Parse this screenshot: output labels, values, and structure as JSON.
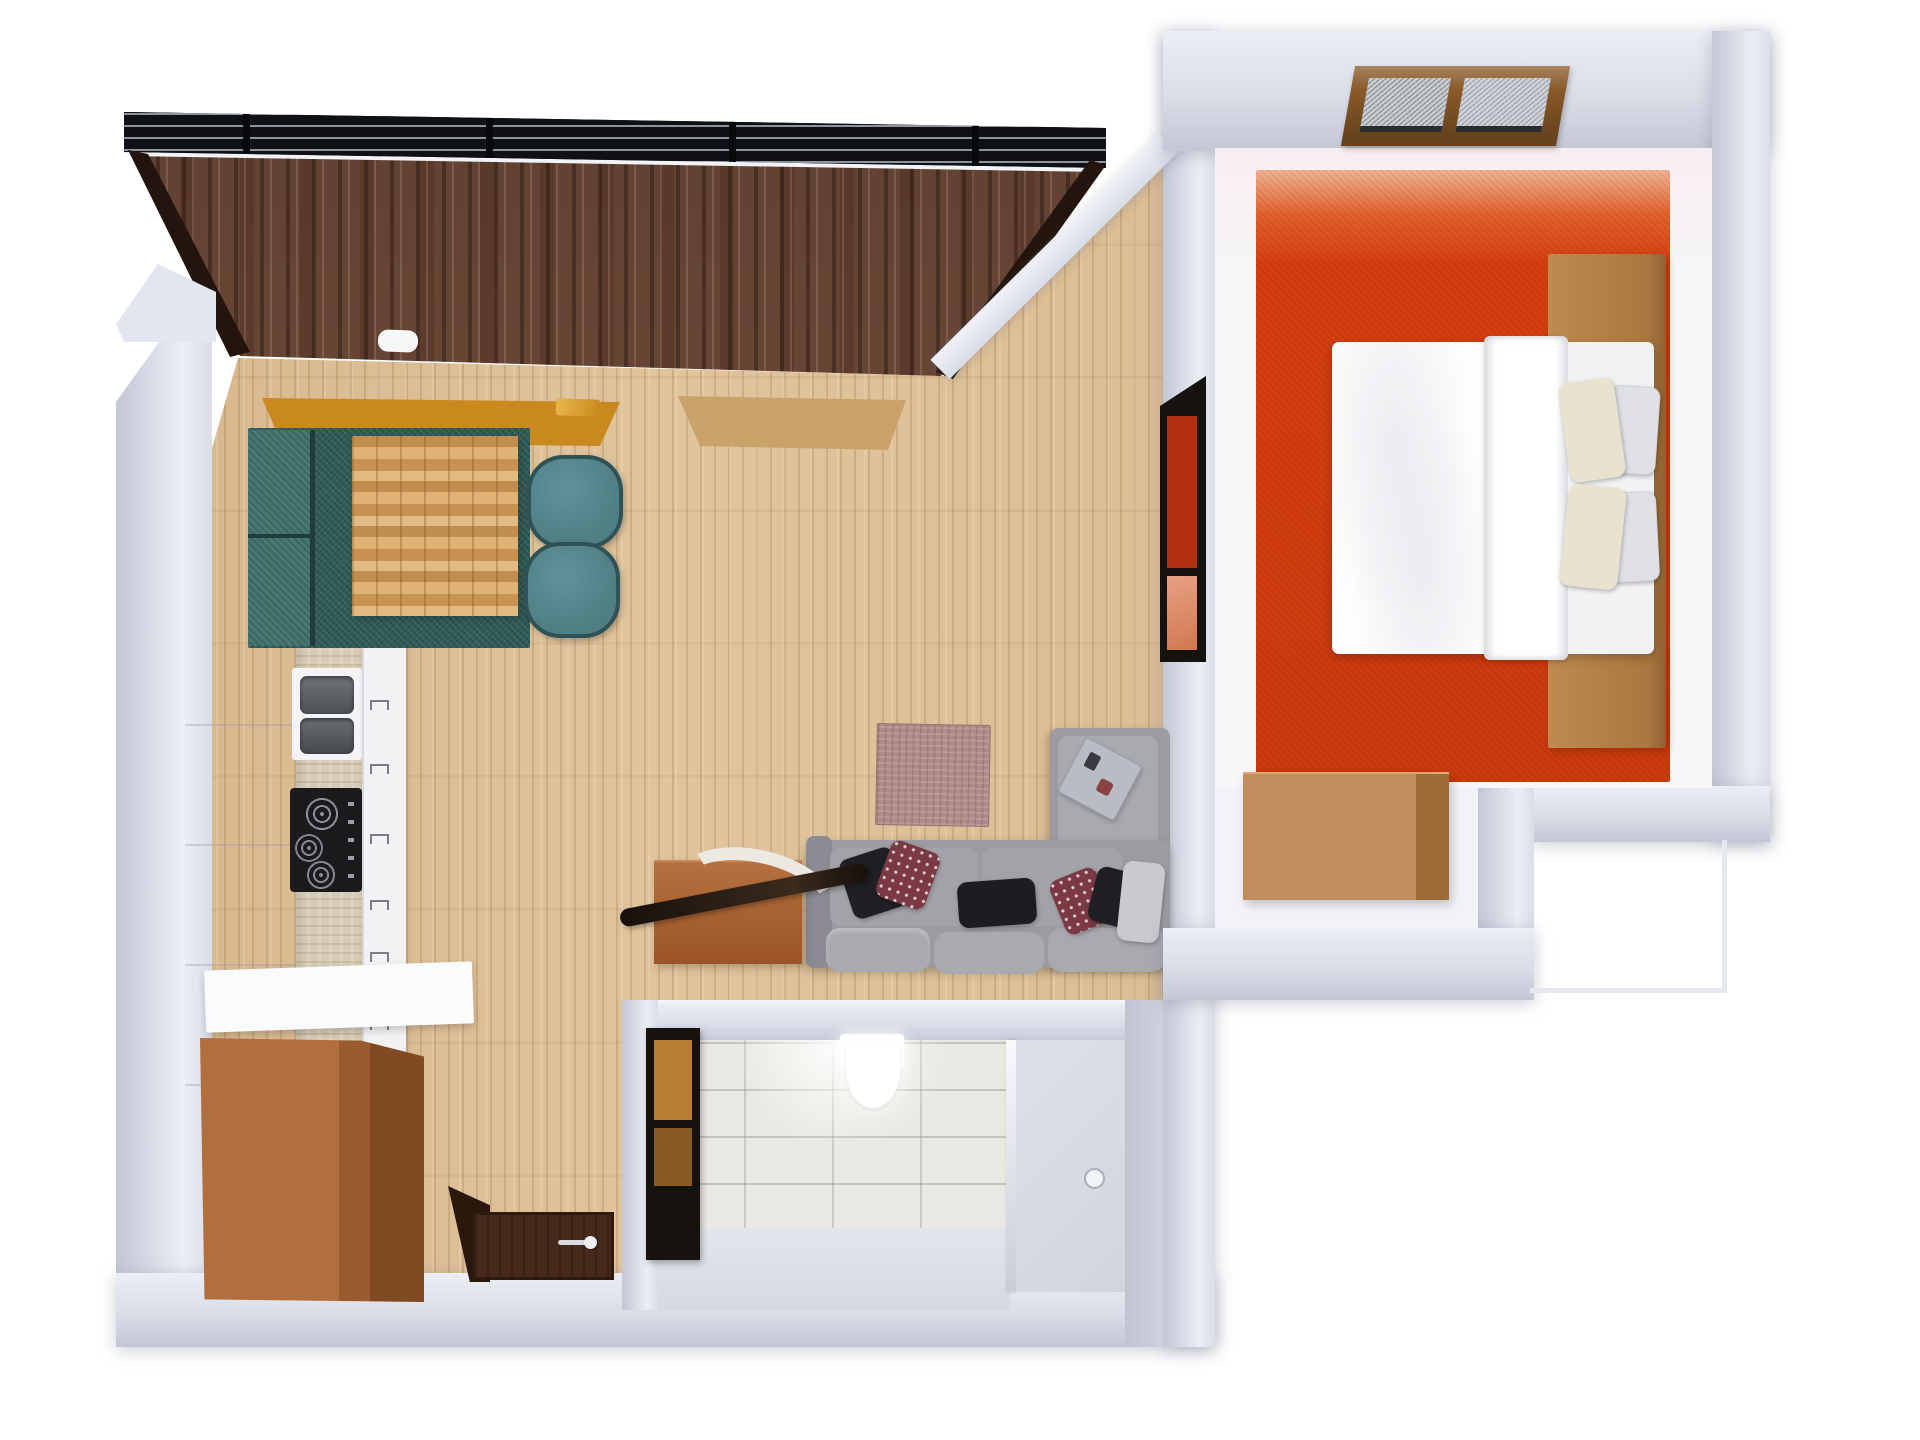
{
  "scene": "3D rendered top-down floor plan of a one-bedroom apartment",
  "colors": {
    "wall": "#dadde8",
    "wall-light": "#eceef5",
    "wall-shadow": "#c3c7d4",
    "floor-wood": "#e0c49c",
    "dark-wood": "#6e4a39",
    "frame-black": "#15161a",
    "teal-rug": "#2f5a57",
    "teal-bench": "#3c6a64",
    "teal-chair": "#4f7f85",
    "table-wood": "#d3a05e",
    "counter-stone": "#d6cbb4",
    "cooktop-black": "#1b1b1e",
    "sink-steel": "#5c6165",
    "sofa-gray": "#9b9ba1",
    "sofa-cushion": "#a9a9b0",
    "rug-mauve": "#b18a8a",
    "desk-wood": "#a85a2c",
    "wardrobe-wood": "#b26f3e",
    "wardrobe-side": "#804a22",
    "door-brown": "#46291a",
    "tile-floor": "#eae8e2",
    "shower-floor": "#d2d5dd",
    "bedroom-carpet": "#d63f10",
    "carpet-fade": "#f2b394",
    "bed-wood": "#bf8a50",
    "dresser-wood": "#c28d5d",
    "window-frame-brown": "#8a5a28",
    "window-amber": "#c9891f",
    "pillow-cream": "#e9e2cf",
    "pillow-gray": "#dfe1e6",
    "sofa-pillow-dark": "#202024",
    "sofa-pillow-red": "#7b3a43",
    "passthrough-red": "#b03010",
    "passthrough-salmon": "#d07850"
  },
  "rooms": [
    {
      "name": "living-room",
      "furniture": [
        "l-shaped-gray-sectional-sofa",
        "throw-pillows",
        "mauve-area-rug",
        "wooden-console-desk",
        "dark-lounge-chair",
        "decor-tray",
        "black-framed-pass-through-panel",
        "brown-framed-window"
      ]
    },
    {
      "name": "dining-area",
      "furniture": [
        "teal-textured-rug",
        "teal-bench",
        "block-wood-dining-table",
        "teal-chair",
        "teal-chair",
        "amber-framed-window",
        "dark-wood-feature-wall",
        "slatted-top-frame"
      ]
    },
    {
      "name": "kitchen",
      "furniture": [
        "tall-white-cabinet",
        "stone-countertop",
        "double-stainless-sink",
        "black-gas-cooktop",
        "drawer-unit-with-handles",
        "white-island-counter"
      ]
    },
    {
      "name": "bedroom",
      "furniture": [
        "red-orange-carpet",
        "double-bed-white-duvet",
        "four-pillows",
        "wood-headboard-platform",
        "wood-nightstand-blocks",
        "wood-dresser",
        "double-pane-wood-window"
      ]
    },
    {
      "name": "bathroom",
      "furniture": [
        "white-toilet",
        "glass-shower-partition",
        "shower-floor-with-drain",
        "dark-framed-vanity",
        "stone-tile-floor"
      ]
    },
    {
      "name": "hallway",
      "furniture": [
        "wood-wardrobe",
        "entry-door-leaf",
        "dark-door-mat",
        "door-handle"
      ]
    }
  ]
}
